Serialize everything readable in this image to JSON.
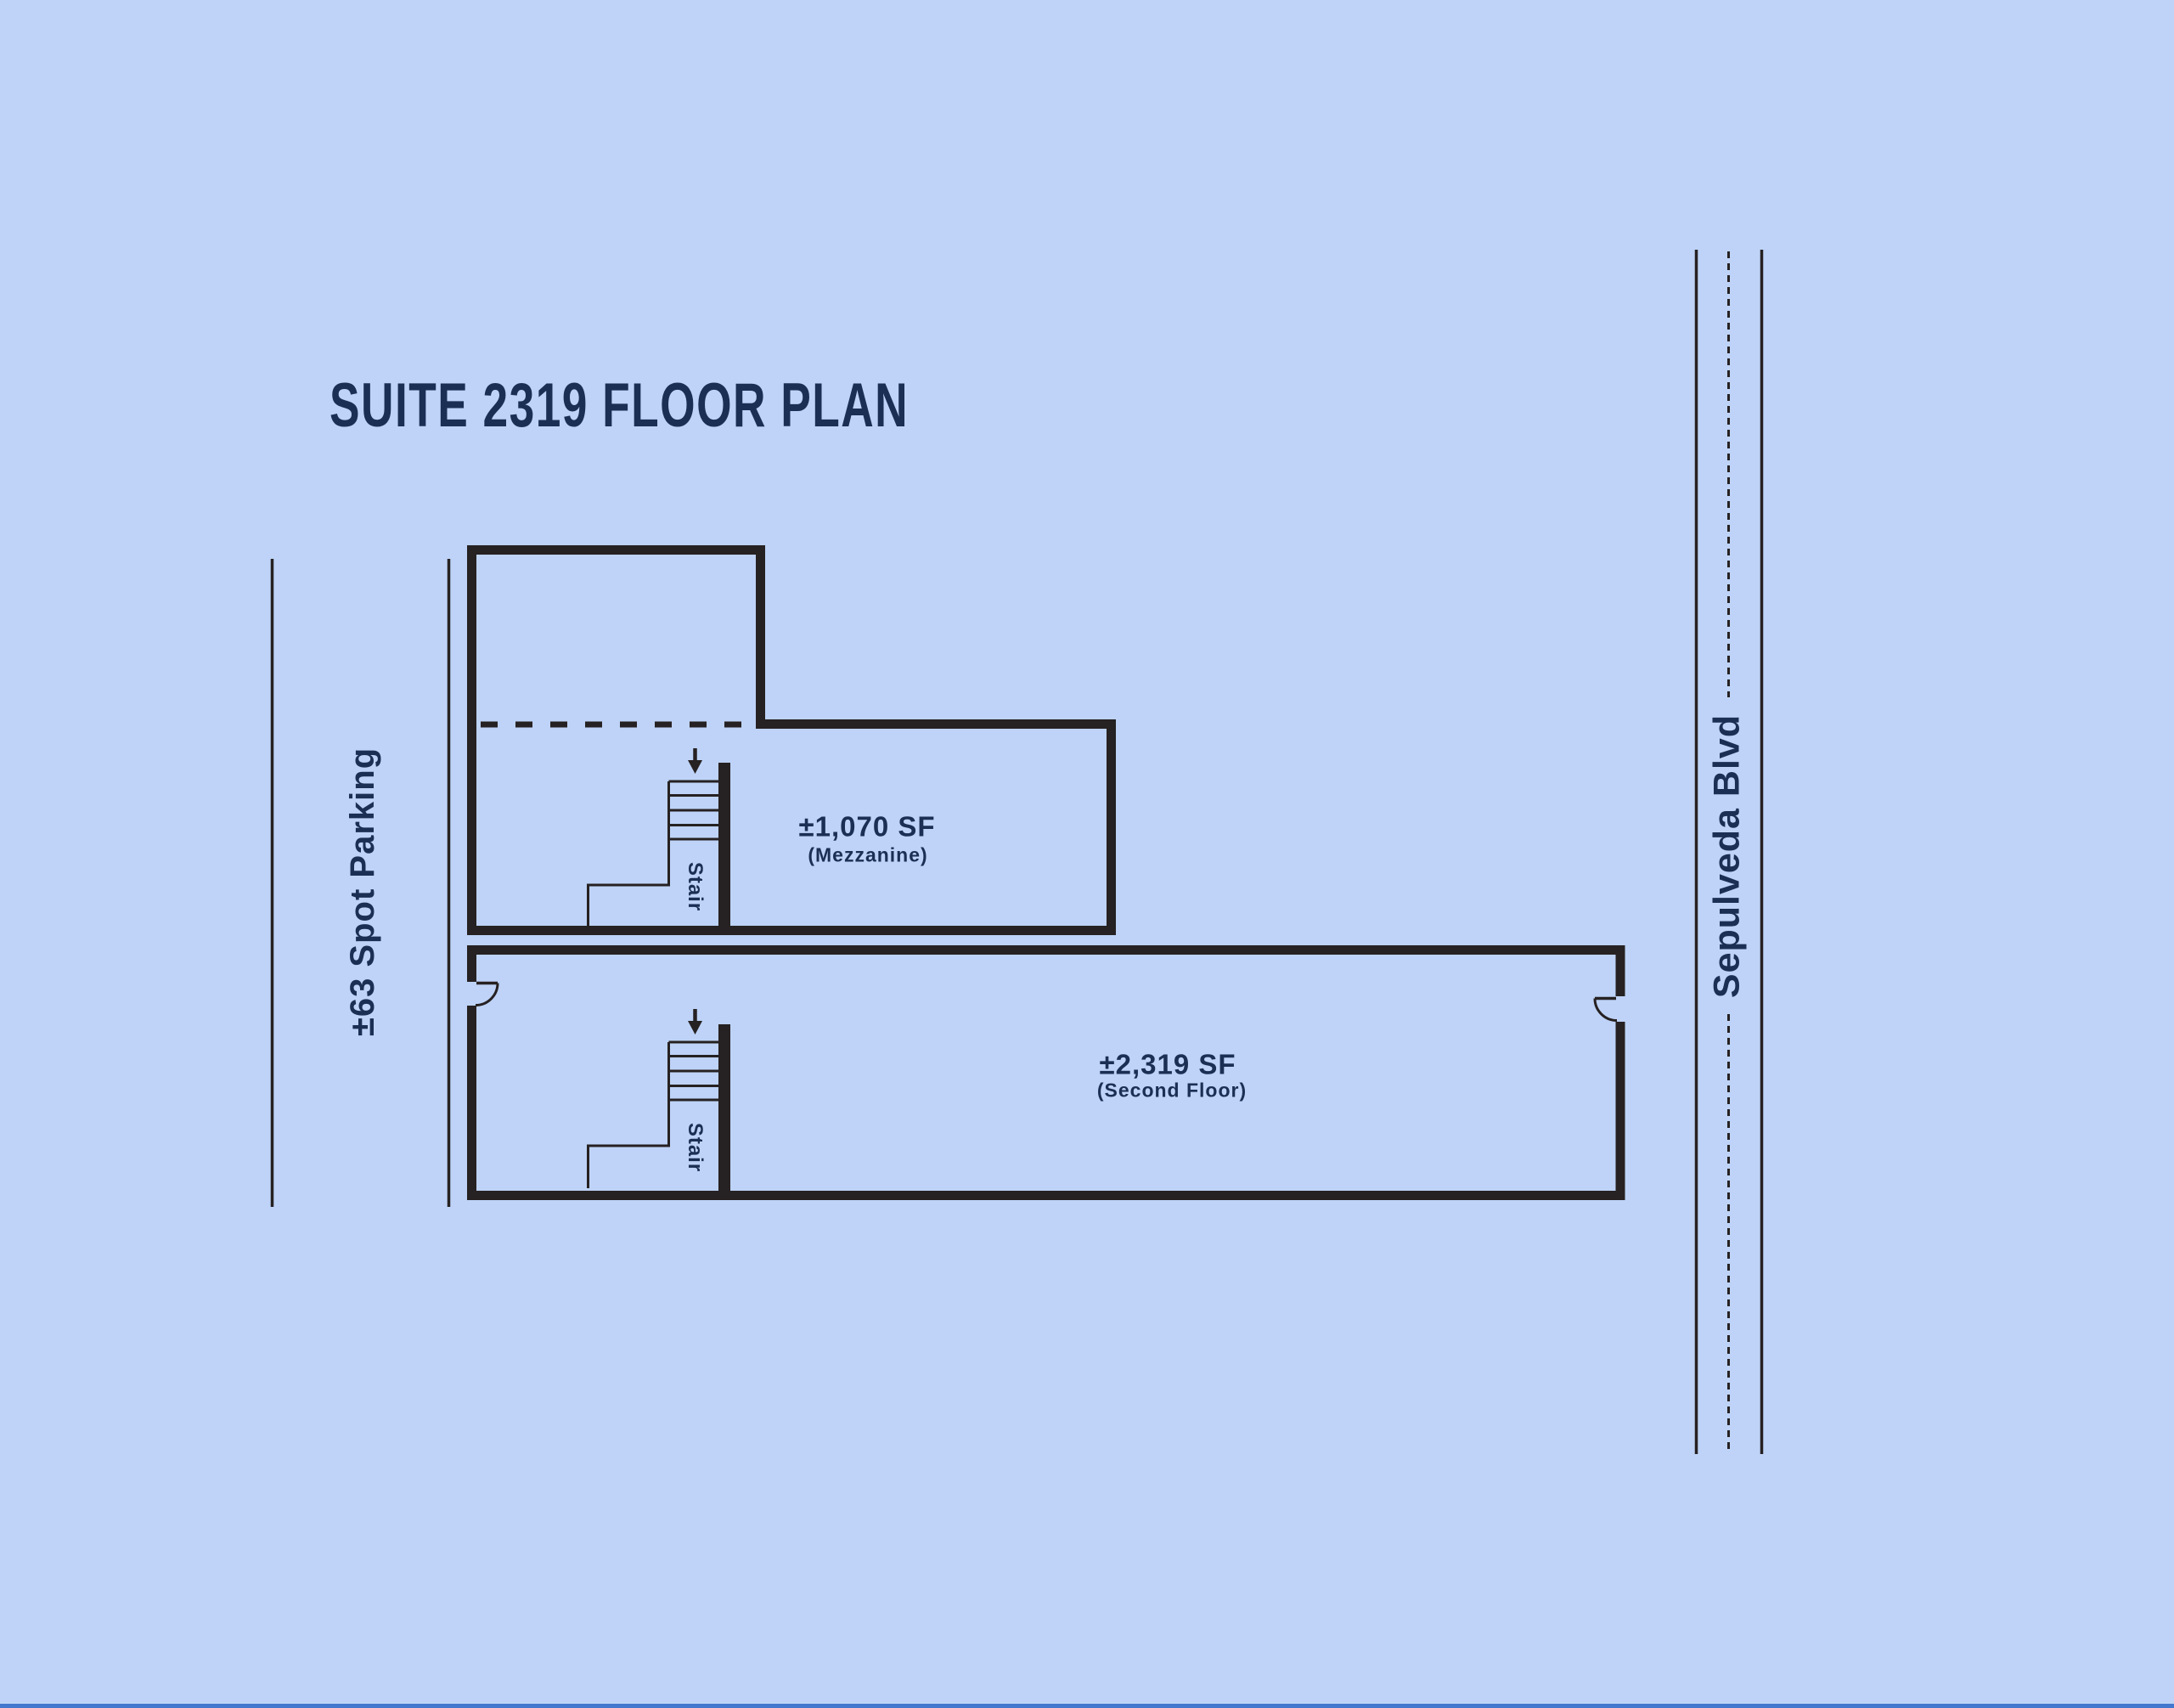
{
  "title": "SUITE 2319 FLOOR PLAN",
  "parking": {
    "label": "±63 Spot Parking"
  },
  "street": {
    "name": "Sepulveda Blvd"
  },
  "mezzanine": {
    "area": "±1,070 SF",
    "floor_label": "(Mezzanine)",
    "stair_label": "Stair"
  },
  "second_floor": {
    "area": "±2,319 SF",
    "floor_label": "(Second Floor)",
    "stair_label": "Stair"
  },
  "colors": {
    "background": "#bed3f7",
    "line_ink": "#262122",
    "text_navy": "#1b2e54",
    "street_edge_blue": "#4478cf"
  }
}
